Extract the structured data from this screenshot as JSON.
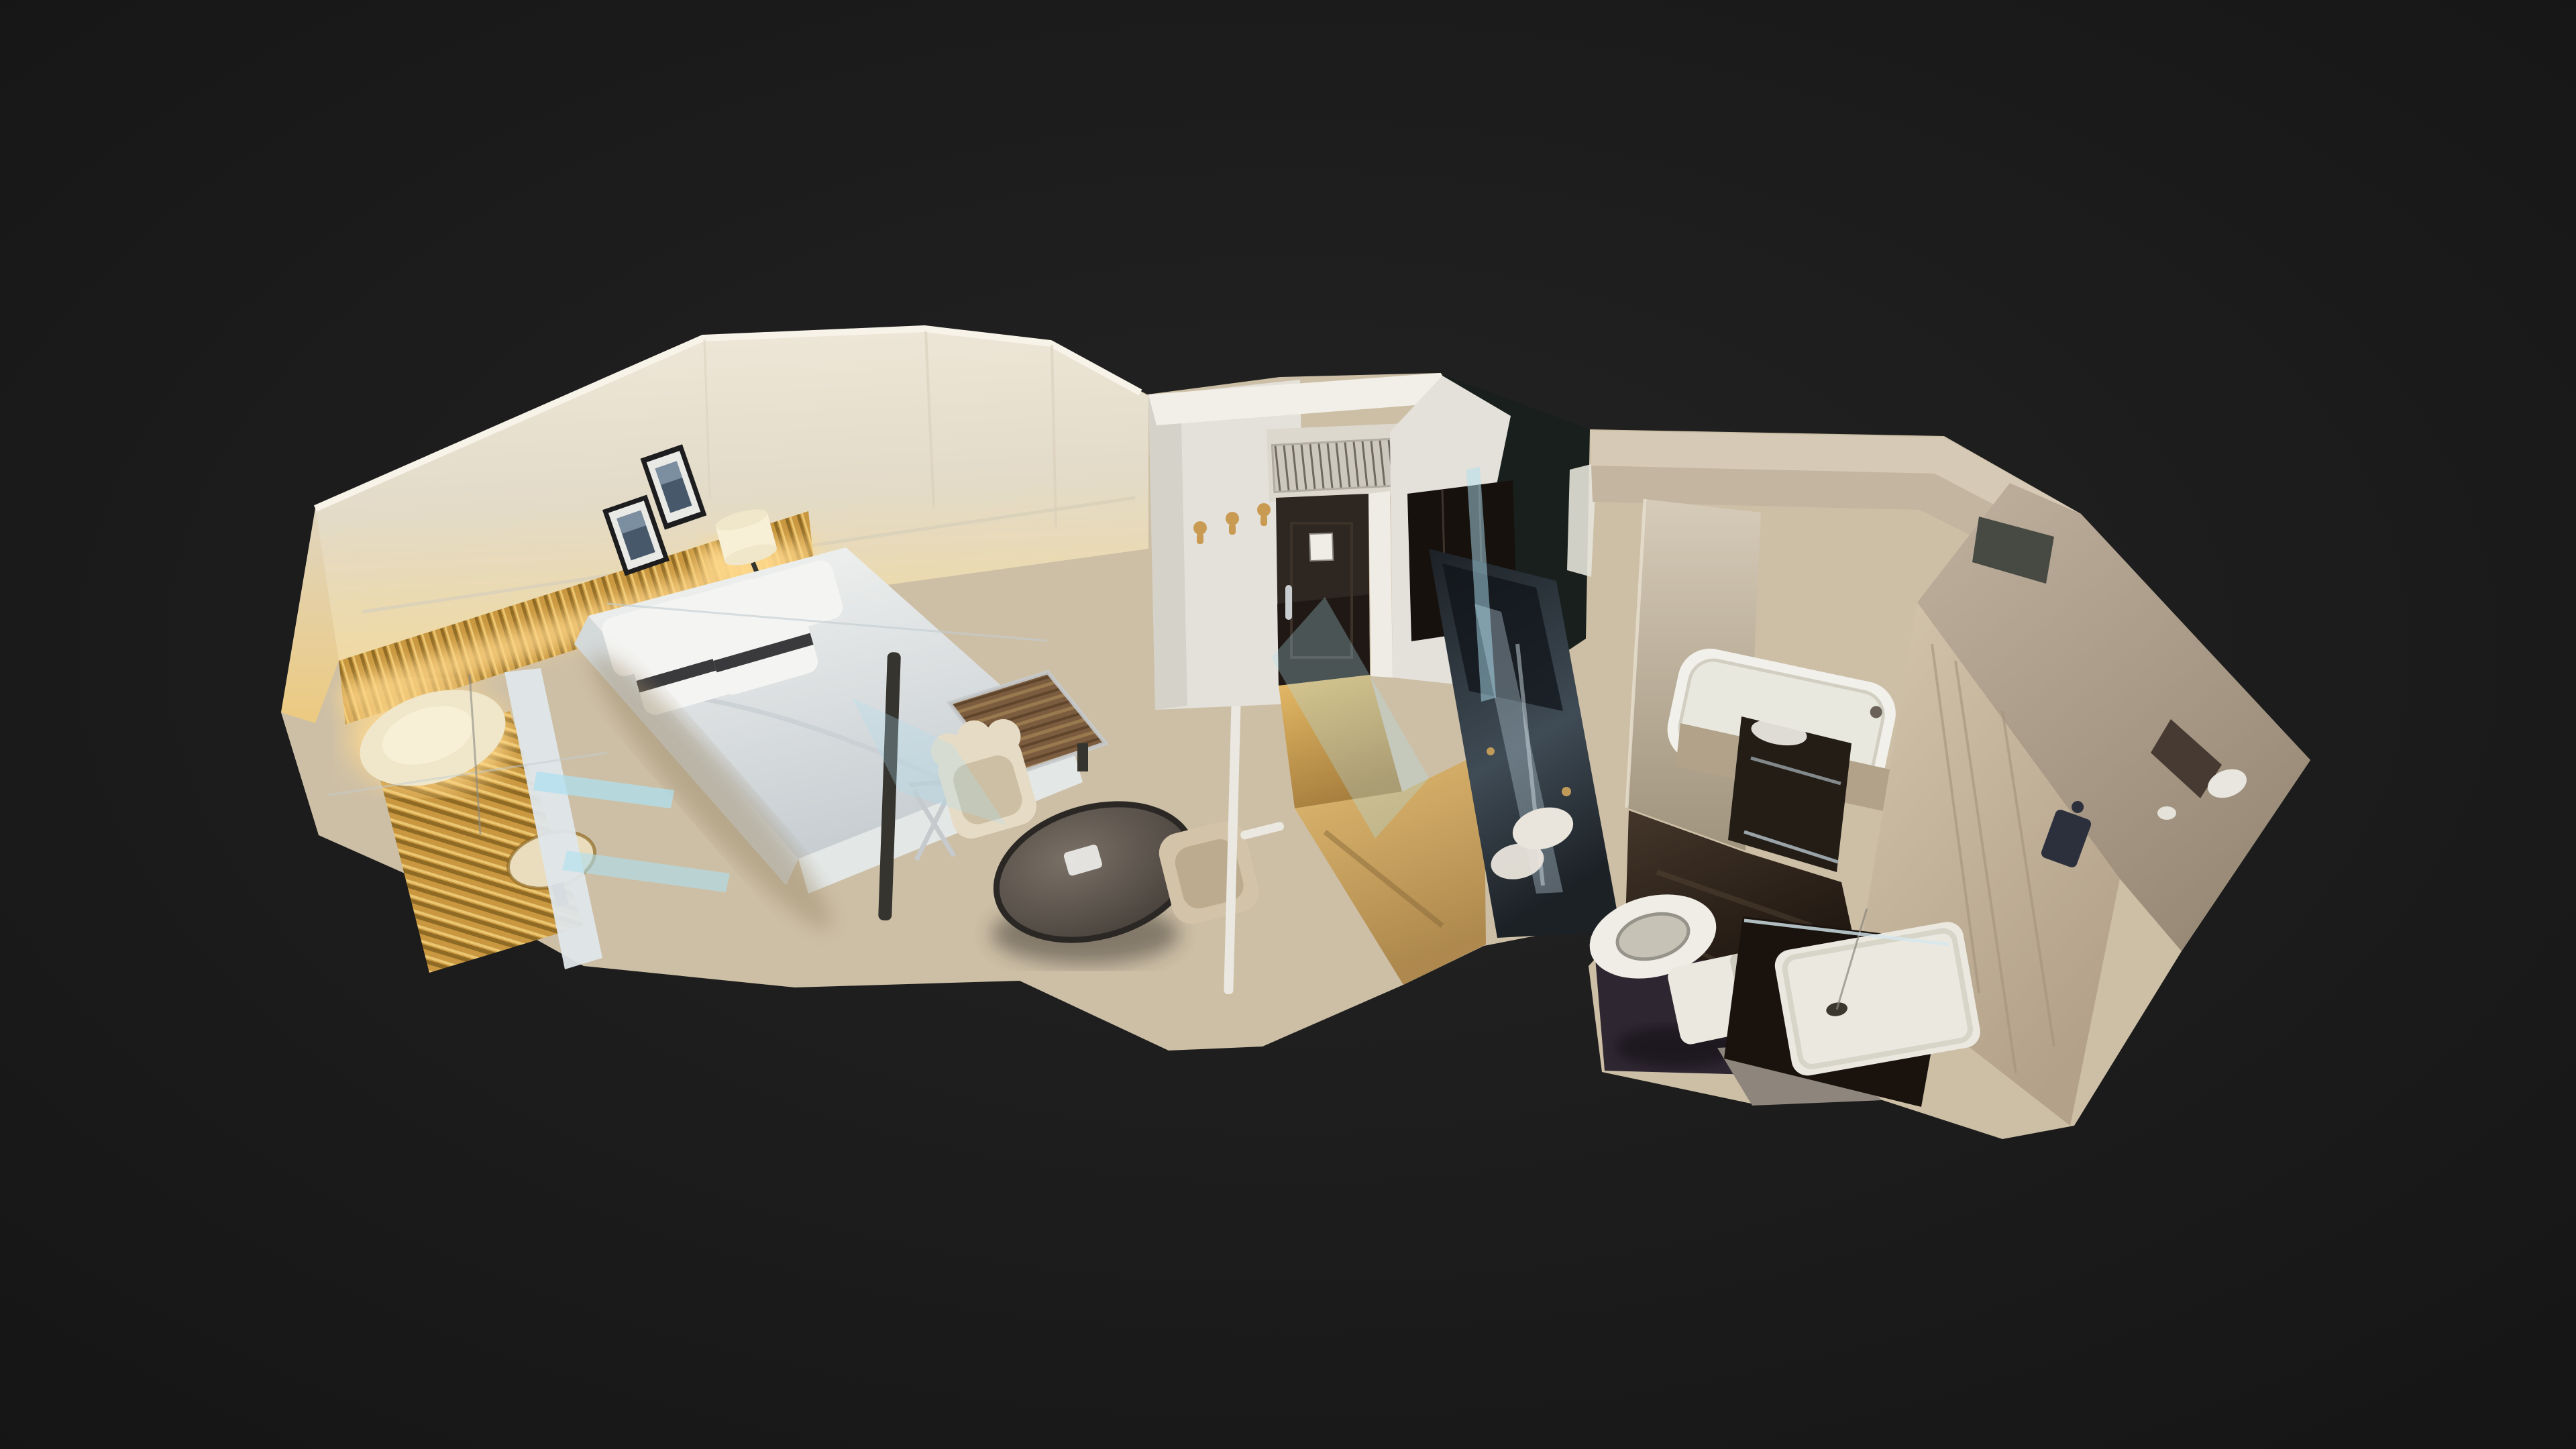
{
  "viewport": {
    "background_center": "#242424",
    "background_edge": "#0c0c0c",
    "mode_label": "dollhouse-3d-view"
  },
  "scene": {
    "description": "Dollhouse cutaway 3D scan of a hotel guest room: bedroom with king bed, gold slat headboard and framed art; entry hall with dark entrance door and coat hooks; marble bathroom with bathtub, vanity, toilet and walk-in shower",
    "rooms": [
      "bedroom",
      "entry-hall",
      "bathroom"
    ]
  },
  "palette": {
    "void": "#181f1c",
    "base": "#cdbfa6",
    "wall_top": "#efe8d9",
    "wall_mid": "#e3dbc8",
    "wall_warm": "#f0d9a2",
    "wall_rim": "#f7f3e9",
    "wall_seam": "#d8cfba",
    "side_wall_top": "#e0d5bf",
    "side_wall_warm": "#ecca80",
    "slat_gold": "#c9973f",
    "slat_dark": "#8f6a24",
    "slat_light": "#eac672",
    "glow": "#ffd98d",
    "frame_black": "#1d1d1f",
    "mat_white": "#e9e9e6",
    "art_dark": "#46586a",
    "art_mid": "#7c8fa0",
    "bed_light": "#f4f5f3",
    "bed_dark": "#c8ced2",
    "bed_side": "#d4d9da",
    "bed_foot": "#e3e7e6",
    "pillow": "#f4f4f2",
    "pillow_stripe": "#3a3a3c",
    "bench_wood": "#7c5c3e",
    "bench_light": "#99794e",
    "bench_dark": "#5f452c",
    "chrome": "#c6cacc",
    "carpet_light": "#d8c9ab",
    "carpet_dark": "#c3b190",
    "carpet_shadow": "#9b8a6a",
    "table_light": "#7a7066",
    "table_dark": "#39342f",
    "table_rim": "#2a2724",
    "chair_cream": "#e6dcc6",
    "chair_cream_inner": "#cdbfa4",
    "chair_beige": "#d3c4a9",
    "chair_beige_inner": "#bcab8e",
    "pole_white": "#eae8e1",
    "pole_dark": "#36342f",
    "entry_face": "#e4e1da",
    "entry_face_shadow": "#cfccc2",
    "entry_top": "#f2efe8",
    "entry_header": "#ddd8ce",
    "vent_bg": "#cdc8be",
    "vent_line": "#6f6a60",
    "hook_gold": "#c89a52",
    "door_top": "#2e2620",
    "door_bottom": "#1c1613",
    "door_card": "#f0ede6",
    "door_handle": "#c9cdd0",
    "door_jamb": "#efece5",
    "entry_floor_light": "#e6bb68",
    "entry_floor_dark": "#a87f3e",
    "wardrobe": "#16110d",
    "slab_top": "#1c2126",
    "slab_mid": "#3f4b55",
    "slab_streak": "#9fb2bd",
    "towel": "#e9e5dc",
    "bath_band_light": "#d6cab6",
    "bath_band": "#c3b5a0",
    "window_dark": "#3b3f3a",
    "divider_light": "#d6cbb8",
    "divider_dark": "#a1947e",
    "tub_white": "#f1f0ea",
    "tub_inner": "#e9e8df",
    "tub_apron": "#b2a28a",
    "vanity_dark": "#241d16",
    "steel": "#9aa4a8",
    "sink_white": "#e9e7df",
    "bath_floor_light": "#44362a",
    "bath_floor_dark": "#160f0a",
    "tile_purple": "#2e2631",
    "floor_gray": "#8e867c",
    "toilet_white": "#efede5",
    "toilet_inner": "#c6c3b6",
    "cistern": "#ebe8df",
    "shower_dark": "#19120d",
    "tray_white": "#ebe8e0",
    "drain": "#3c372e",
    "marble_light": "#d4c5ad",
    "marble_dark": "#b3a189",
    "marble_seam": "#a5947c",
    "fixture_dark": "#2b303c",
    "rwall_light": "#c0b19f",
    "rwall_dark": "#978975",
    "recess_dark": "#463a32",
    "blob_white": "#ecebe4",
    "artifact_cyan": "#aee0ef",
    "artifact_pole": "#dfe6ea",
    "scanline": "#c3cdd2",
    "shade_cream": "#f0e6c9",
    "shade_inner": "#f7efd6",
    "side_table": "#e9ddbd"
  }
}
